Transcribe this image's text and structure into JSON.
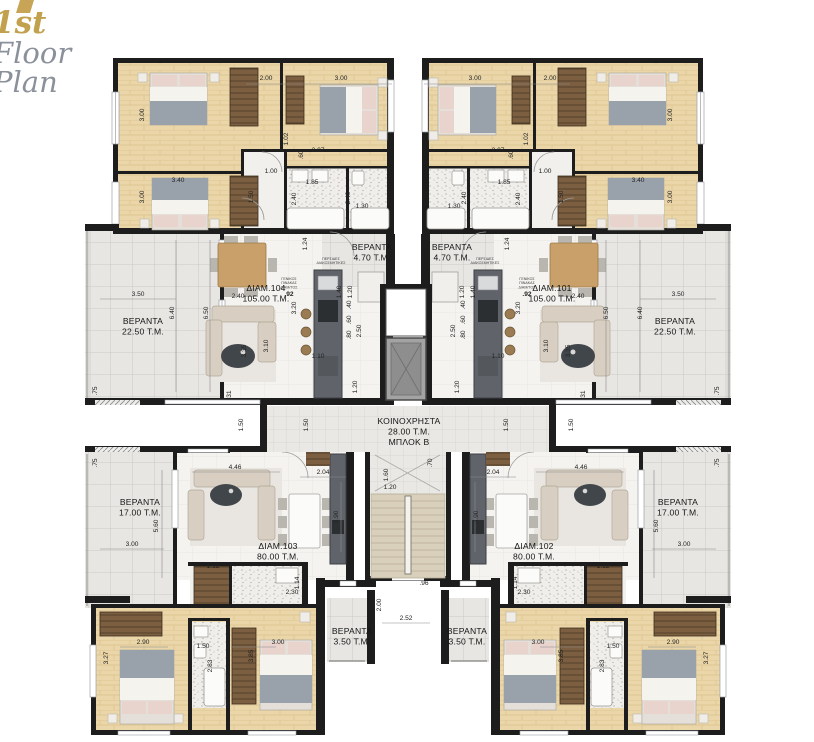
{
  "title": {
    "line1": "1st",
    "line2": "Floor",
    "line3": "Plan"
  },
  "colors": {
    "accent_gold": "#c2a14e",
    "title_gray": "#8b919b",
    "wall_black": "#1d1d1d",
    "wood_floor": "#ead6a8",
    "veranda_tile": "#e7e6e3",
    "kitchen_gray": "#60646a",
    "stair_beige": "#d9d0bc"
  },
  "apartments": [
    {
      "name": "ΔΙΑΜ.104",
      "area": "105.00 Τ.Μ."
    },
    {
      "name": "ΔΙΑΜ.101",
      "area": "105.00 Τ.Μ."
    },
    {
      "name": "ΔΙΑΜ.103",
      "area": "80.00 Τ.Μ."
    },
    {
      "name": "ΔΙΑΜ.102",
      "area": "80.00 Τ.Μ."
    }
  ],
  "common_area": {
    "name": "ΚΟΙΝΟΧΡΗΣΤΑ",
    "area": "28.00 Τ.Μ.",
    "block": "ΜΠΛΟΚ Β"
  },
  "plan": {
    "room_labels": [
      {
        "lines": [
          "ΒΕΡΑΝΤΑ",
          "4.70 Τ.Μ."
        ],
        "x": 372,
        "y": 250
      },
      {
        "lines": [
          "ΒΕΡΑΝΤΑ",
          "4.70 Τ.Μ."
        ],
        "x": 452,
        "y": 250
      },
      {
        "lines": [
          "ΔΙΑΜ.104",
          "105.00 Τ.Μ."
        ],
        "x": 266,
        "y": 291
      },
      {
        "lines": [
          "ΔΙΑΜ.101",
          "105.00 Τ.Μ."
        ],
        "x": 552,
        "y": 291
      },
      {
        "lines": [
          "ΒΕΡΑΝΤΑ",
          "22.50 Τ.Μ."
        ],
        "x": 143,
        "y": 324
      },
      {
        "lines": [
          "ΒΕΡΑΝΤΑ",
          "22.50 Τ.Μ."
        ],
        "x": 675,
        "y": 324
      },
      {
        "lines": [
          "ΚΟΙΝΟΧΡΗΣΤΑ",
          "28.00 Τ.Μ.",
          "ΜΠΛΟΚ Β"
        ],
        "x": 409,
        "y": 424
      },
      {
        "lines": [
          "ΒΕΡΑΝΤΑ",
          "17.00 Τ.Μ."
        ],
        "x": 140,
        "y": 505
      },
      {
        "lines": [
          "ΒΕΡΑΝΤΑ",
          "17.00 Τ.Μ."
        ],
        "x": 678,
        "y": 505
      },
      {
        "lines": [
          "ΔΙΑΜ.103",
          "80.00 Τ.Μ."
        ],
        "x": 278,
        "y": 549
      },
      {
        "lines": [
          "ΔΙΑΜ.102",
          "80.00 Τ.Μ."
        ],
        "x": 534,
        "y": 549
      },
      {
        "lines": [
          "ΒΕΡΑΝΤΑ",
          "3.50 Τ.Μ."
        ],
        "x": 352,
        "y": 634
      },
      {
        "lines": [
          "ΒΕΡΑΝΤΑ",
          "3.50 Τ.Μ."
        ],
        "x": 467,
        "y": 634
      }
    ],
    "tiny_labels": [
      {
        "lines": [
          "ΠΕΡΣΙΔΕΣ",
          "ΔΙΑΚΟΣΜΗΤΙΚΕΣ"
        ],
        "x": 331,
        "y": 260,
        "m": 1
      },
      {
        "lines": [
          "ΓΕΝΙΚΟΣ",
          "ΠΙΝΑΚΑΣ",
          "ΔΙΑΜ/ΤΟΣ"
        ],
        "x": 289,
        "y": 280,
        "m": 1
      }
    ],
    "dims": [
      {
        "t": "3.00",
        "x": 144,
        "y": 115,
        "r": -90,
        "m": 1
      },
      {
        "t": "2.00",
        "x": 266,
        "y": 80,
        "m": 1
      },
      {
        "t": "3.00",
        "x": 341,
        "y": 80,
        "m": 1
      },
      {
        "t": "1.02",
        "x": 288,
        "y": 139,
        "r": -90,
        "m": 1
      },
      {
        "t": ".60",
        "x": 303,
        "y": 155,
        "r": -90,
        "m": 1
      },
      {
        "t": "2.07",
        "x": 318,
        "y": 152,
        "m": 1
      },
      {
        "t": "1.00",
        "x": 271,
        "y": 173,
        "m": 1
      },
      {
        "t": "1.85",
        "x": 312,
        "y": 184,
        "m": 1
      },
      {
        "t": "2.40",
        "x": 296,
        "y": 199,
        "r": -90,
        "m": 1
      },
      {
        "t": "2.40",
        "x": 350,
        "y": 198,
        "r": -90,
        "m": 1
      },
      {
        "t": "1.30",
        "x": 362,
        "y": 208,
        "m": 1
      },
      {
        "t": "3.40",
        "x": 178,
        "y": 182,
        "m": 1
      },
      {
        "t": "3.00",
        "x": 144,
        "y": 197,
        "r": -90,
        "m": 1
      },
      {
        "t": "1.50",
        "x": 253,
        "y": 197,
        "r": -90,
        "m": 1
      },
      {
        "t": "1.24",
        "x": 307,
        "y": 244,
        "r": -90,
        "m": 1
      },
      {
        "t": "1.40",
        "x": 341,
        "y": 292,
        "r": -90,
        "m": 1
      },
      {
        "t": "1.20",
        "x": 352,
        "y": 292,
        "r": -90,
        "m": 1
      },
      {
        "t": "2.40",
        "x": 238,
        "y": 298,
        "m": 1
      },
      {
        "t": "3.20",
        "x": 296,
        "y": 308,
        "r": -90,
        "m": 1
      },
      {
        "t": "6.50",
        "x": 208,
        "y": 313,
        "r": -90,
        "m": 1
      },
      {
        "t": "6.40",
        "x": 174,
        "y": 313,
        "r": -90,
        "m": 1
      },
      {
        "t": "3.50",
        "x": 138,
        "y": 296,
        "m": 1
      },
      {
        "t": "3.10",
        "x": 268,
        "y": 346,
        "r": -90,
        "m": 1
      },
      {
        "t": "3.35",
        "x": 246,
        "y": 351,
        "r": -90,
        "m": 1
      },
      {
        "t": "1.10",
        "x": 318,
        "y": 358,
        "m": 1
      },
      {
        "t": ".40",
        "x": 351,
        "y": 305,
        "r": -90,
        "m": 1
      },
      {
        "t": ".60",
        "x": 351,
        "y": 320,
        "r": -90,
        "m": 1
      },
      {
        "t": ".80",
        "x": 351,
        "y": 335,
        "r": -90,
        "m": 1
      },
      {
        "t": "2.50",
        "x": 361,
        "y": 331,
        "r": -90,
        "m": 1
      },
      {
        "t": "1.20",
        "x": 357,
        "y": 387,
        "r": -90,
        "m": 1
      },
      {
        "t": ".31",
        "x": 231,
        "y": 395,
        "r": -90,
        "m": 1
      },
      {
        "t": ".75",
        "x": 97,
        "y": 391,
        "r": -90,
        "m": 1
      },
      {
        "t": ".75",
        "x": 97,
        "y": 463,
        "r": -90,
        "m": 1
      },
      {
        "t": "1.50",
        "x": 243,
        "y": 425,
        "r": -90,
        "m": 1
      },
      {
        "t": "1.50",
        "x": 308,
        "y": 425,
        "r": -90,
        "m": 1
      },
      {
        "t": "4.46",
        "x": 235,
        "y": 469,
        "m": 1
      },
      {
        "t": "2.04",
        "x": 323,
        "y": 474,
        "m": 1
      },
      {
        "t": "3.90",
        "x": 338,
        "y": 517,
        "r": -90,
        "m": 1
      },
      {
        "t": "1.12",
        "x": 213,
        "y": 568,
        "m": 1
      },
      {
        "t": "2.30",
        "x": 292,
        "y": 594,
        "m": 1
      },
      {
        "t": "1.14",
        "x": 299,
        "y": 583,
        "r": -90,
        "m": 1
      },
      {
        "t": "2.90",
        "x": 143,
        "y": 644,
        "m": 1
      },
      {
        "t": "3.27",
        "x": 108,
        "y": 658,
        "r": -90,
        "m": 1
      },
      {
        "t": "1.50",
        "x": 203,
        "y": 648,
        "m": 1
      },
      {
        "t": "2.83",
        "x": 212,
        "y": 666,
        "r": -90,
        "m": 1
      },
      {
        "t": "3.85",
        "x": 253,
        "y": 656,
        "r": -90,
        "m": 1
      },
      {
        "t": "3.00",
        "x": 278,
        "y": 644,
        "m": 1
      },
      {
        "t": "5.60",
        "x": 158,
        "y": 526,
        "r": -90,
        "m": 1
      },
      {
        "t": "3.00",
        "x": 132,
        "y": 546,
        "m": 1
      },
      {
        "t": ".92",
        "x": 289,
        "y": 296,
        "b": 1,
        "m": 1
      },
      {
        "t": ".70",
        "x": 432,
        "y": 463,
        "r": -90
      },
      {
        "t": "1.60",
        "x": 388,
        "y": 475,
        "r": -90
      },
      {
        "t": "1.20",
        "x": 390,
        "y": 489
      },
      {
        "t": ".96",
        "x": 424,
        "y": 585
      },
      {
        "t": "2.00",
        "x": 381,
        "y": 605,
        "r": -90
      },
      {
        "t": "2.52",
        "x": 406,
        "y": 620
      }
    ]
  }
}
